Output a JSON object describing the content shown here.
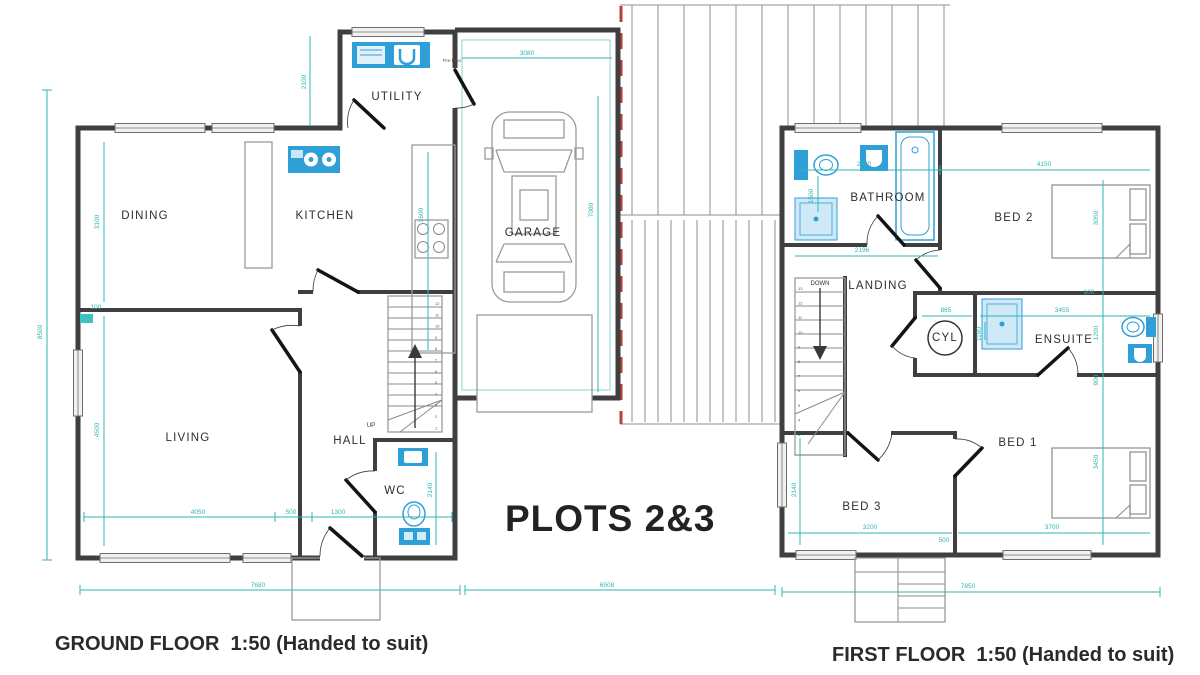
{
  "title": "PLOTS 2&3",
  "colors": {
    "dimension_teal": "#2fb5b5",
    "fixture_blue": "#2f9fd8",
    "fixture_light_blue": "#cfe9f7",
    "boundary_red": "#b84038",
    "wall_grey": "#3f3f3f"
  },
  "ground_floor": {
    "caption": "GROUND FLOOR  1:50 (Handed to suit)",
    "rooms": {
      "dining": "DINING",
      "kitchen": "KITCHEN",
      "utility": "UTILITY",
      "living": "LIVING",
      "hall": "HALL",
      "wc": "WC",
      "garage": "GARAGE"
    },
    "stairs": {
      "direction": "UP",
      "steps_top_to_bottom": [
        "12",
        "11",
        "10",
        "9",
        "8",
        "7",
        "6",
        "5",
        "4",
        "3",
        "2",
        "1"
      ]
    },
    "notes": {
      "fire_door": "Fire Door"
    },
    "dims": {
      "utility_depth": "2100",
      "garage_width": "3080",
      "garage_depth": "7080",
      "kitchen_run": "2600",
      "dining_depth": "3100",
      "wall_thickness": "100",
      "living_depth": "4500",
      "side_overall": "8500",
      "living_width": "4050",
      "hall_a": "500",
      "hall_b": "1300",
      "wc_depth": "2140",
      "front_overall": "7680",
      "link_overall": "6508"
    }
  },
  "first_floor": {
    "caption": "FIRST FLOOR  1:50 (Handed to suit)",
    "rooms": {
      "bathroom": "BATHROOM",
      "bed2": "BED 2",
      "landing": "LANDING",
      "cyl": "CYL",
      "ensuite": "ENSUITE",
      "bed1": "BED 1",
      "bed3": "BED 3"
    },
    "stairs": {
      "direction": "DOWN",
      "steps_top_to_bottom": [
        "13",
        "12",
        "11",
        "10",
        "9",
        "8",
        "7",
        "6",
        "5",
        "4",
        "3"
      ]
    },
    "dims": {
      "bathroom_width": "2080",
      "bed2_width": "4150",
      "bath_length": "1500",
      "bathroom_length": "2196",
      "bed2_depth": "3050",
      "wall_thickness": "100",
      "cyl_width": "865",
      "ensuite_width": "3455",
      "ensuite_depth": "1180",
      "ensuite_d2": "1200",
      "d900": "900",
      "bed3_depth": "2140",
      "bed3_width": "3200",
      "bed1_width": "3700",
      "d500": "500",
      "bed1_depth": "3450",
      "front_overall": "7850"
    }
  }
}
